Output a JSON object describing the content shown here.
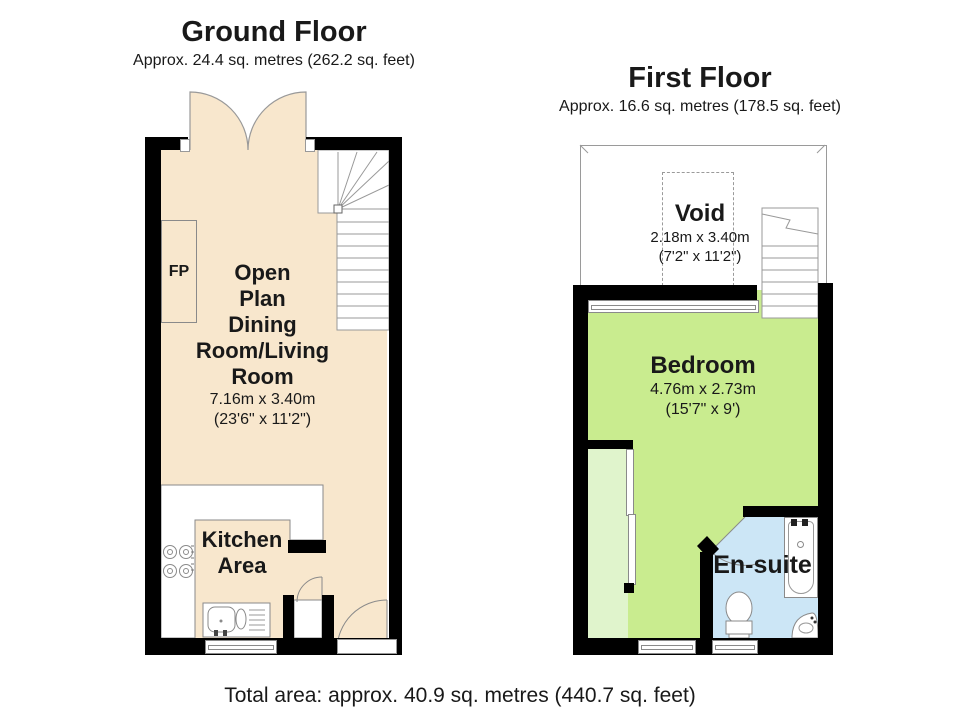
{
  "ground_floor": {
    "title": "Ground Floor",
    "area": "Approx. 24.4 sq. metres (262.2 sq. feet)",
    "living_room": {
      "lines": [
        "Open",
        "Plan",
        "Dining",
        "Room/Living",
        "Room"
      ],
      "size_metric": "7.16m x 3.40m",
      "size_imperial": "(23'6\" x 11'2\")"
    },
    "kitchen": {
      "lines": [
        "Kitchen",
        "Area"
      ]
    },
    "fireplace_label": "FP"
  },
  "first_floor": {
    "title": "First Floor",
    "area": "Approx. 16.6 sq. metres (178.5 sq. feet)",
    "void_space": {
      "name": "Void",
      "size_metric": "2.18m x 3.40m",
      "size_imperial": "(7'2\" x 11'2\")"
    },
    "bedroom": {
      "name": "Bedroom",
      "size_metric": "4.76m x 2.73m",
      "size_imperial": "(15'7\" x 9')"
    },
    "ensuite": {
      "name": "En-suite"
    }
  },
  "footer": {
    "total_area": "Total area: approx. 40.9 sq. metres (440.7 sq. feet)"
  },
  "colors": {
    "floor_beige": "#F8E7CD",
    "bedroom_green": "#C9EC8F",
    "closet_green": "#E0F4CC",
    "ensuite_blue": "#CCE6F6",
    "wall_black": "#000000",
    "outline_gray": "#8A8A8A"
  }
}
